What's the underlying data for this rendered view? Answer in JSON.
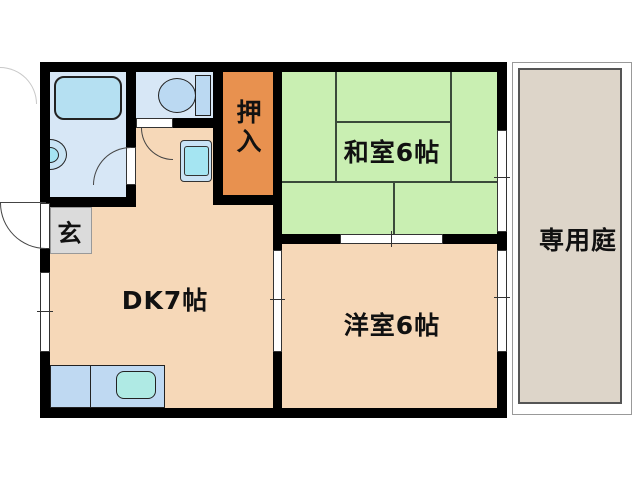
{
  "floorplan": {
    "type": "japanese-apartment-floor-plan",
    "labels": {
      "washitsu": "和室6帖",
      "dk": "DK7帖",
      "yoshitsu": "洋室6帖",
      "oshiire": "押入",
      "genkan": "玄",
      "garden": "専用庭"
    },
    "colors": {
      "wall": "#000000",
      "tatami_green": "#C9EFB2",
      "room_peach": "#F6D8B8",
      "closet_orange": "#E8914F",
      "water_room_blue": "#D7E7F6",
      "bathtub_blue": "#B5E0F2",
      "basin_blue": "#C8E4F4",
      "toilet_blue": "#BBD9F2",
      "counter_blue": "#BFD9F2",
      "sink_cyan": "#AFEAE4",
      "washer_outer_blue": "#C9E2F5",
      "washer_inner_cyan": "#A5E5F2",
      "genkan_gray": "#DBDBDB",
      "garden_beige": "#DDD5C9"
    },
    "fixtures": {
      "bathtub": "css-rounded-rect",
      "washbasin": "css-half-circle",
      "toilet": "css-ellipse-plus-tank",
      "washing-machine-pan": "css-nested-rects",
      "kitchen-counter": "css-rect-with-divider",
      "kitchen-sink": "css-rounded-rect",
      "door-swing": "css-quarter-arc",
      "window": "css-double-line"
    }
  }
}
